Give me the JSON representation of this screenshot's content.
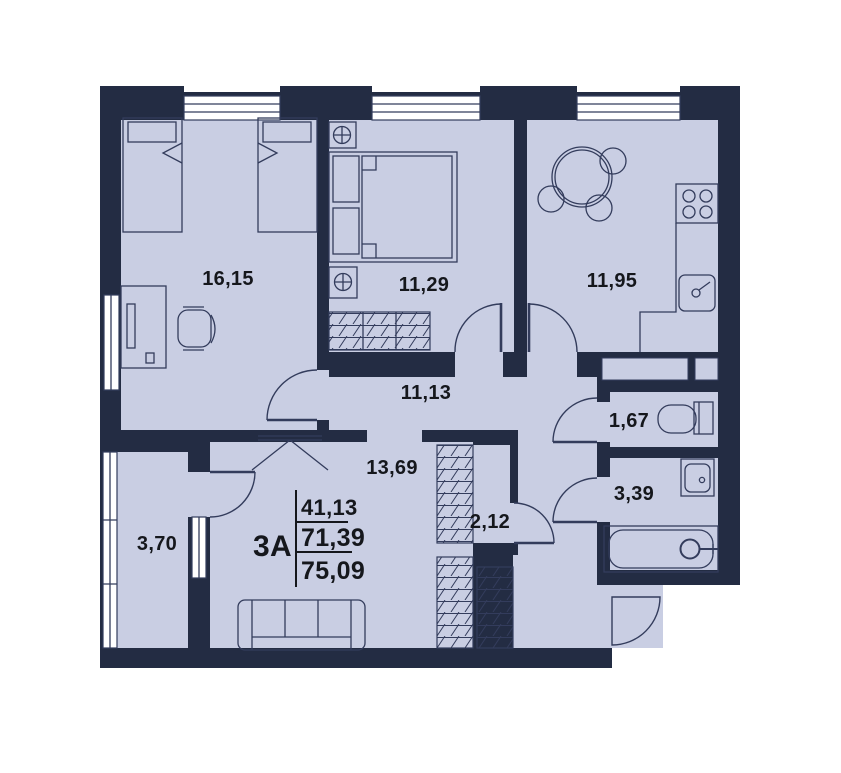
{
  "plan": {
    "summary": {
      "type": "3А",
      "living": "41,13",
      "without_balcony": "71,39",
      "total": "75,09"
    },
    "rooms": [
      {
        "id": "bedroom-1",
        "area": "16,15"
      },
      {
        "id": "bedroom-2",
        "area": "11,29"
      },
      {
        "id": "kitchen",
        "area": "11,95"
      },
      {
        "id": "hallway",
        "area": "11,13"
      },
      {
        "id": "living-area",
        "area": "13,69"
      },
      {
        "id": "balcony",
        "area": "3,70"
      },
      {
        "id": "wardrobe",
        "area": "2,12"
      },
      {
        "id": "wc",
        "area": "1,67"
      },
      {
        "id": "bathroom",
        "area": "3,39"
      }
    ],
    "colors": {
      "wall": "#232c43",
      "floor": "#c9cee3",
      "line": "#333c5c",
      "window": "#ffffff",
      "text": "#15171c",
      "background": "#ffffff"
    }
  }
}
